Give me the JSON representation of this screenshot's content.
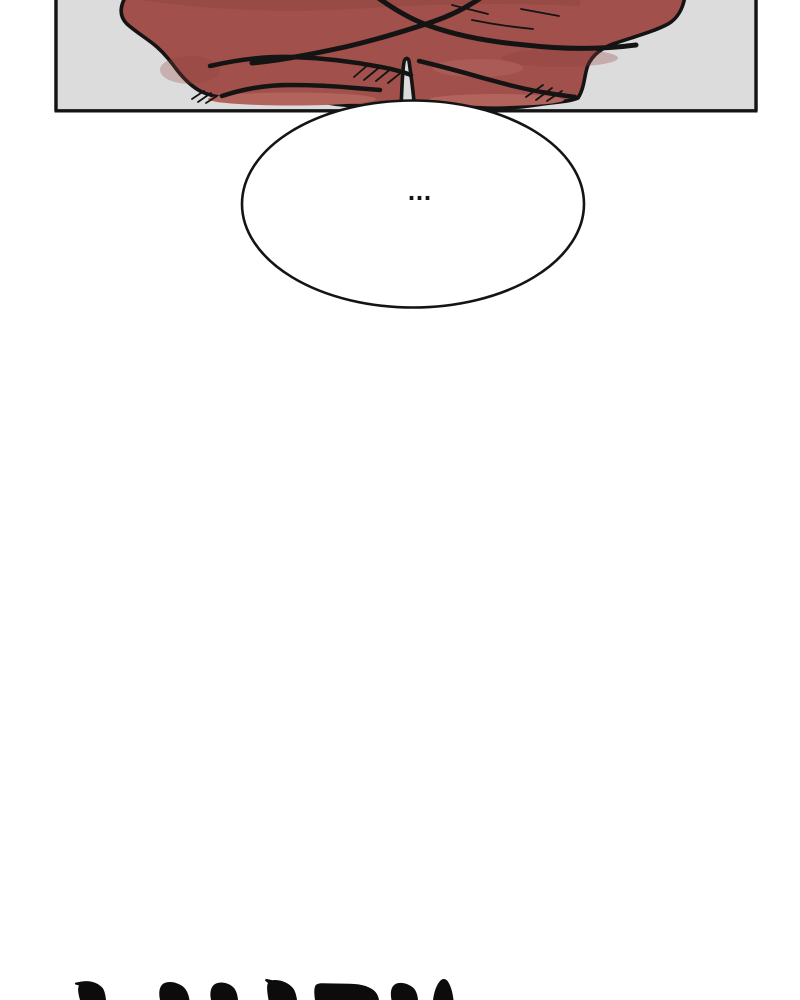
{
  "page": {
    "background": "#ffffff"
  },
  "panel": {
    "background": "#dcdcdc",
    "border_color": "#141414",
    "content_description": "cropped comic panel: torso of a figure in a red robe with folded arms, head and lower body out of frame",
    "colors": {
      "robe_base": "#a1504b",
      "robe_light": "#b2635c",
      "robe_dark": "#8f433e",
      "line": "#141414"
    }
  },
  "speech_bubble": {
    "text": "...",
    "fill": "#ffffff",
    "stroke": "#141414"
  },
  "bottom_lettering": {
    "description": "tops of large hand-lettered black comic text, cut off by the bottom edge of the image",
    "color": "#0c0c0c"
  }
}
